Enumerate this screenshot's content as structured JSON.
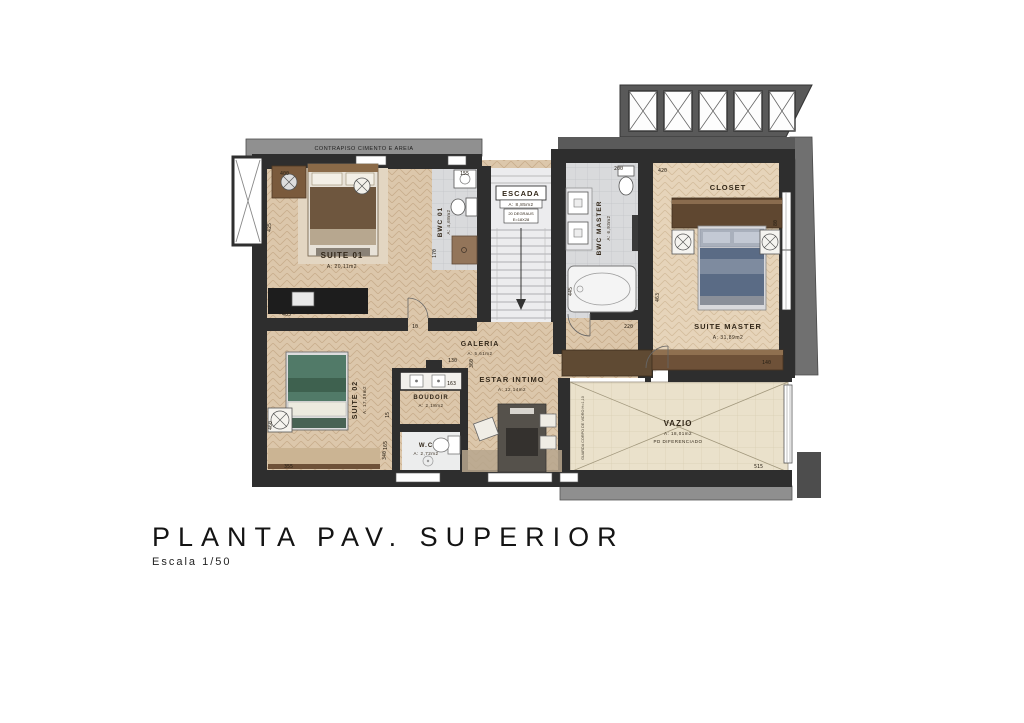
{
  "title": {
    "main": "PLANTA PAV. SUPERIOR",
    "scale": "Escala 1/50"
  },
  "watermark": "SEVEN",
  "notes": {
    "contrapiso": "CONTRAPISO CIMENTO E AREIA",
    "guardrail": "GUARDA CORPO DE VIDRO H=1,10"
  },
  "rooms": {
    "suite01": {
      "name": "SUITE 01",
      "area": "A: 20,11m2"
    },
    "bwc01": {
      "name": "BWC 01",
      "area": "A: 4,68m2"
    },
    "escada": {
      "name": "ESCADA",
      "area": "A: 8,85m2",
      "note1": "20 DEGRAUS",
      "note2": "E=18X28"
    },
    "bwc_master": {
      "name": "BWC MASTER",
      "area": "A: 6,93m2"
    },
    "closet": {
      "name": "CLOSET"
    },
    "suite_master": {
      "name": "SUITE MASTER",
      "area": "A: 31,89m2"
    },
    "galeria": {
      "name": "GALERIA",
      "area": "A: 5,61m2"
    },
    "suite02": {
      "name": "SUITE 02",
      "area": "A: 17,39m2"
    },
    "boudoir": {
      "name": "BOUDOIR",
      "area": "A: 2,18m2"
    },
    "wc": {
      "name": "W.C",
      "area": "A: 2,72m2"
    },
    "estar": {
      "name": "ESTAR INTIMO",
      "area": "A: 12,14m2"
    },
    "vazio": {
      "name": "VAZIO",
      "area": "A: 18,01m2",
      "note": "PD DIFERENCIADO"
    }
  },
  "dims": {
    "d400": "400",
    "d425": "425",
    "d405": "405",
    "d10": "10",
    "d155": "155",
    "d170": "170",
    "d200": "200",
    "d420": "420",
    "d445": "445",
    "d220": "220",
    "d463": "463",
    "d140": "140",
    "d515": "515",
    "d355": "355",
    "d340": "340",
    "d460": "460",
    "d360": "360",
    "d130": "130",
    "d163": "163",
    "d165": "165",
    "d15": "15",
    "d80": "80"
  },
  "colors": {
    "wall": "#2e2e2e",
    "concrete": "#8f8f8f",
    "wood": "#dcc7ab",
    "wood_master": "#e6d4ba",
    "tile": "#d9dadc",
    "vazio": "#eae1cb",
    "bed_master_cover": "#5a6b85",
    "bed_suite02_cover": "#517a68"
  }
}
